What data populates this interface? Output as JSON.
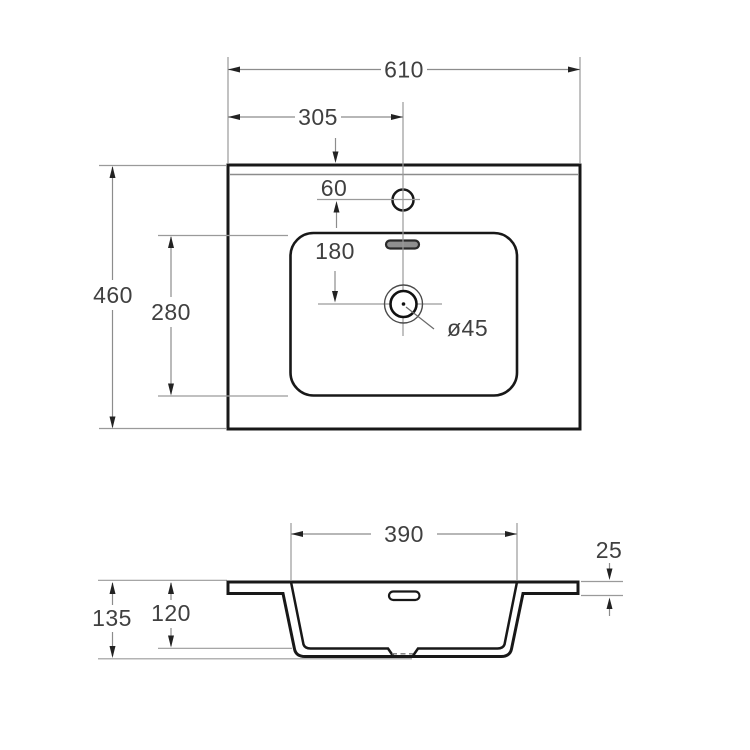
{
  "top_view": {
    "total_width": "610",
    "center_offset": "305",
    "faucet_offset": "60",
    "faucet_to_drain": "180",
    "bowl_length": "280",
    "total_depth": "460",
    "drain_diameter": "ø45"
  },
  "section_view": {
    "bowl_width": "390",
    "rim_thickness": "25",
    "bowl_depth": "120",
    "total_height": "135"
  }
}
